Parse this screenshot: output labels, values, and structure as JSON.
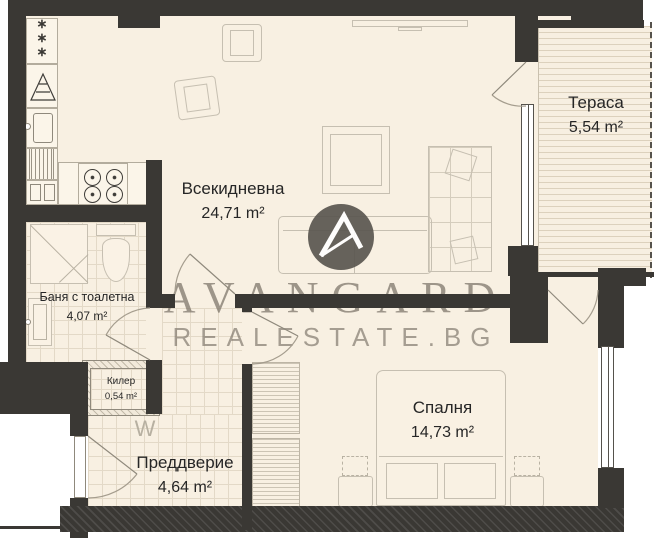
{
  "plan": {
    "rooms": [
      {
        "name": "Всекидневна",
        "area": "24,71 m²"
      },
      {
        "name": "Тераса",
        "area": "5,54 m²"
      },
      {
        "name": "Баня с тоалетна",
        "area": "4,07 m²"
      },
      {
        "name": "Килер",
        "area": "0,54 m²"
      },
      {
        "name": "Преддверие",
        "area": "4,64 m²"
      },
      {
        "name": "Спалня",
        "area": "14,73 m²"
      }
    ],
    "symbols": {
      "washing_machine": "W",
      "fridge_star": "∗"
    }
  },
  "watermark": {
    "brand": "AVANGARD",
    "site": "REALESTATE.BG"
  },
  "colors": {
    "wall": "#3a3834",
    "floor": "#f8f0e2",
    "tile_line": "#e3d9c7",
    "furniture_line": "#c6bfb1",
    "watermark_text": "#7a7267",
    "logo_circle": "#5a5650"
  }
}
